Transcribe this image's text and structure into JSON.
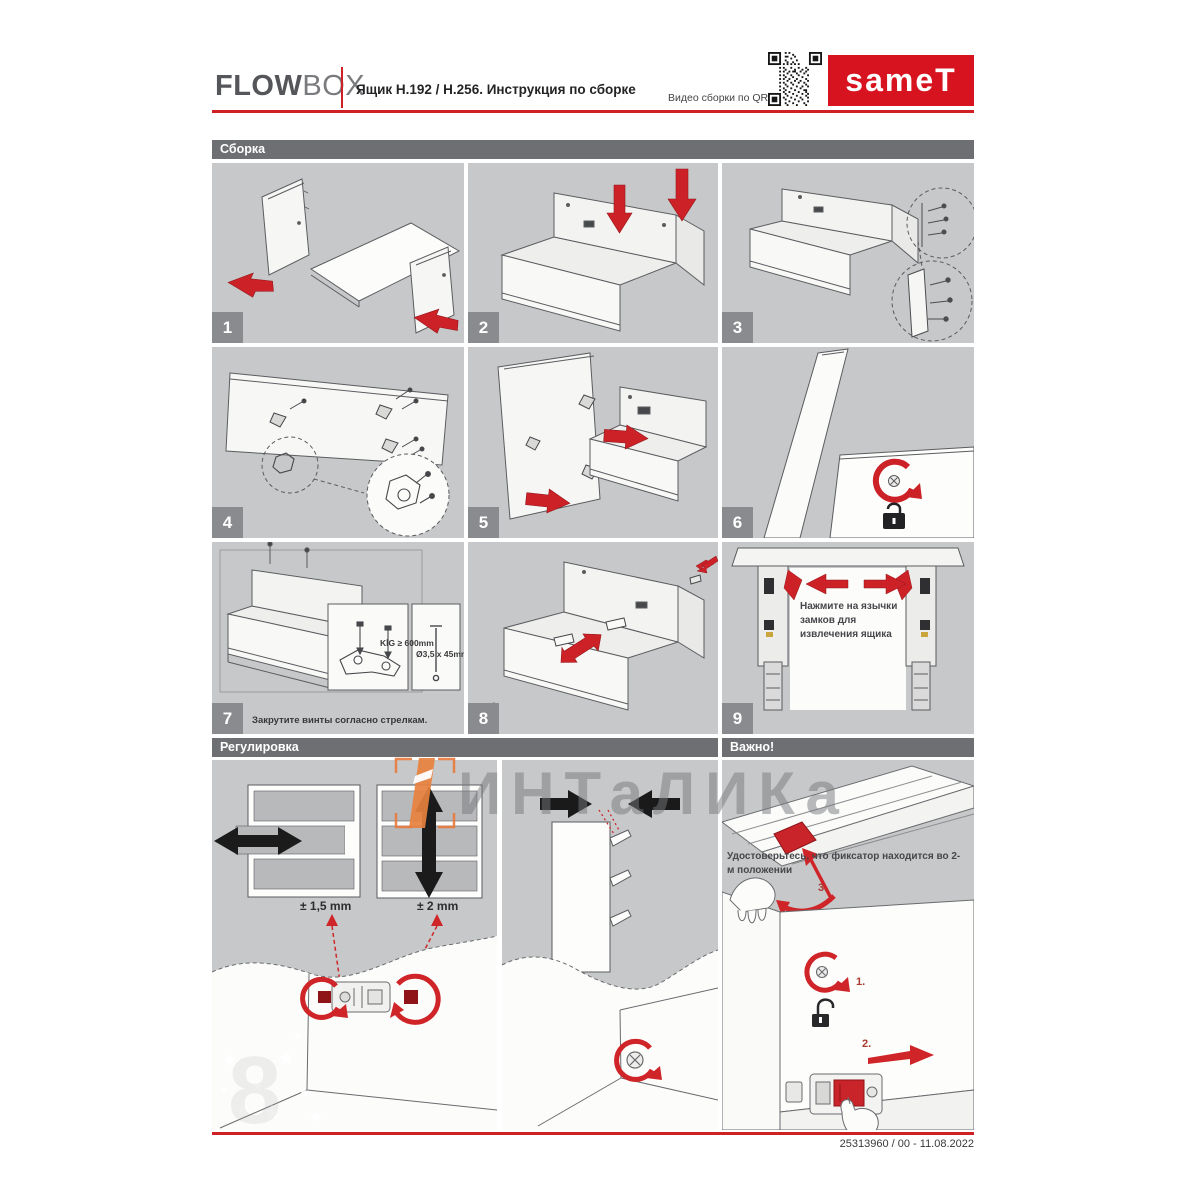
{
  "header": {
    "brand_bold": "FLOW",
    "brand_light": "BOX",
    "title": "Ящик Н.192 / Н.256. Инструкция по сборке",
    "qr_caption": "Видео сборки по QR",
    "logo_text": "sameT"
  },
  "sections": {
    "assembly": "Сборка",
    "adjustment": "Регулировка",
    "important": "Важно!"
  },
  "steps": [
    {
      "number": "1"
    },
    {
      "number": "2"
    },
    {
      "number": "3"
    },
    {
      "number": "4"
    },
    {
      "number": "5"
    },
    {
      "number": "6"
    },
    {
      "number": "7",
      "caption": "Закрутите винты согласно стрелкам.",
      "inset_kig": "KİG ≥ 600mm",
      "inset_screw": "Ø3,5 x 45mm"
    },
    {
      "number": "8"
    },
    {
      "number": "9",
      "note": "Нажмите на язычки замков для извлечения ящика"
    }
  ],
  "adjustment": {
    "horizontal_label": "± 1,5 mm",
    "vertical_label": "± 2 mm"
  },
  "important": {
    "note": "Удостоверьтесь, что фиксатор находится во 2-м положении",
    "marker_1": "1.",
    "marker_2": "2.",
    "marker_3": "3."
  },
  "watermark": {
    "text": "ИНТаЛИКа",
    "faint_digit": "8"
  },
  "footer": {
    "doc_ref": "25313960 / 00 - 11.08.2022"
  },
  "colors": {
    "brand_red": "#cf2026",
    "panel_gray": "#c7c8c9",
    "bar_gray": "#6e6f72",
    "watermark_orange": "#e8813f"
  }
}
